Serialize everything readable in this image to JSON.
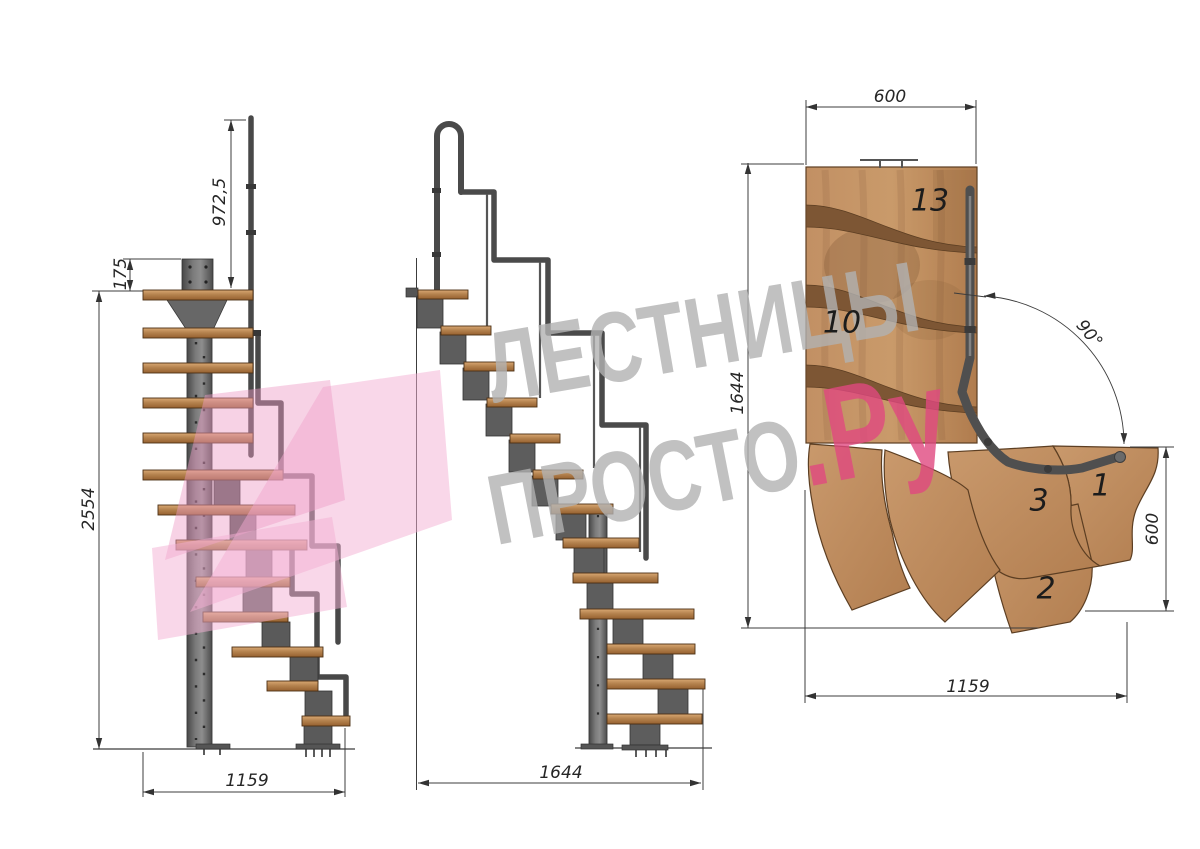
{
  "page": {
    "background": "#ffffff",
    "description": "Modular staircase technical drawing, three views"
  },
  "watermark": {
    "line1": "ЛЕСТНИЦЫ",
    "line2_grey": "ПРОСТО",
    "line2_pink": ".Ру",
    "grey_color": "#b2b2b2",
    "pink_color": "#e0487f"
  },
  "front_view": {
    "dim_handrail_height": "972,5",
    "dim_plate_height": "175",
    "dim_total_height": "2554",
    "dim_total_width": "1159"
  },
  "side_view": {
    "dim_total_length": "1644"
  },
  "plan_view": {
    "dim_top_width": "600",
    "dim_left_length": "1644",
    "dim_turn_angle": "90°",
    "dim_right_width": "600",
    "dim_bottom_length": "1159",
    "step_labels": {
      "top": "13",
      "middle": "10",
      "third": "3",
      "first": "1",
      "second": "2"
    }
  },
  "colors": {
    "wood": "#c08b5c",
    "wood_shadow": "#7d5634",
    "metal": "#4a4a4a",
    "dimension_line": "#3c3c3c"
  }
}
